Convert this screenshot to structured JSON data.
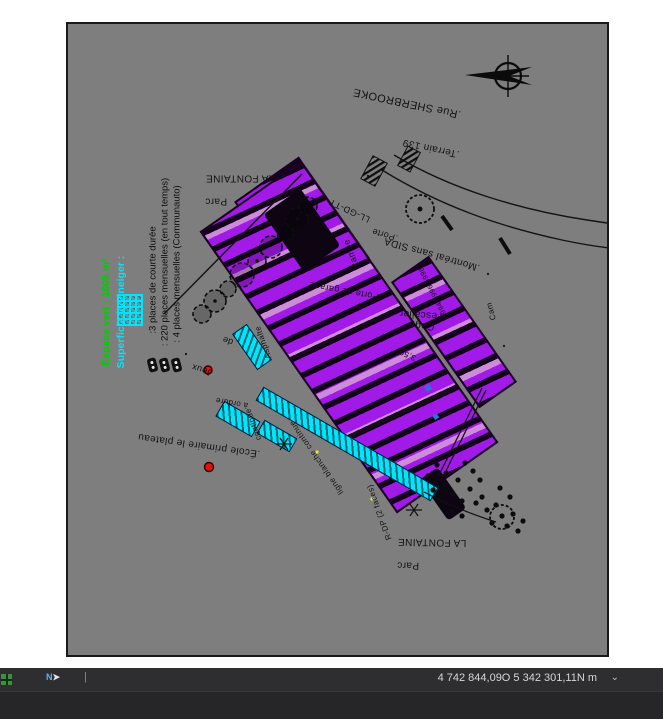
{
  "colors": {
    "window_bg": "#ffffff",
    "canvas": "#7e7e7e",
    "magenta": "#a21ae8",
    "lavender": "#d198d8",
    "cyan": "#00e5ff",
    "green": "#00cc00",
    "red": "#e01111",
    "ink": "#121212",
    "bar_bg": "#2e2e31",
    "panel_bg": "#262629",
    "bar_text": "#d6d6d6",
    "blue": "#2f6fd6"
  },
  "statusbar": {
    "coordinates": "4 742 844,09O 5 342 301,11N m",
    "chevron": "⌄",
    "nav_letter": "N",
    "nav_arrow": "➤",
    "separator": "|"
  },
  "legend": {
    "espace_vert": "Espace vert : 1605 m²",
    "superficie": "Superficie à déneiger :",
    "items": [
      {
        "label": ":3 places de courte durée"
      },
      {
        "label": ": 220 places mensuelles (en tout temps)"
      },
      {
        "label": ": 4 places mensuelles (Communauto)"
      }
    ]
  },
  "map_labels": [
    {
      "text": "LA FONTAINE"
    },
    {
      "text": "Parc"
    },
    {
      "text": ".Rue SHERBROOKE"
    },
    {
      "text": ".Terrain 139"
    },
    {
      "text": ".Montréal sans SIDA"
    },
    {
      "text": "Cage\nd'escalier"
    },
    {
      "text": "5994 5996 5998"
    },
    {
      "text": "Cam"
    },
    {
      "text": ".Porte"
    },
    {
      "text": "Porte de garage"
    },
    {
      "text": "Rampe"
    },
    {
      "text": "LL-GD-TT"
    },
    {
      "text": "Asphalte"
    },
    {
      "text": "ligne blanche continue"
    },
    {
      "text": "continue"
    },
    {
      "text": "à ordure"
    },
    {
      "text": "de"
    },
    {
      "text": "Jeux"
    },
    {
      "text": ".École primaire le plateau"
    },
    {
      "text": "LA FONTAINE"
    },
    {
      "text": "Parc"
    },
    {
      "text": "R-DP (2 faces)"
    },
    {
      "text": "3,50"
    }
  ]
}
